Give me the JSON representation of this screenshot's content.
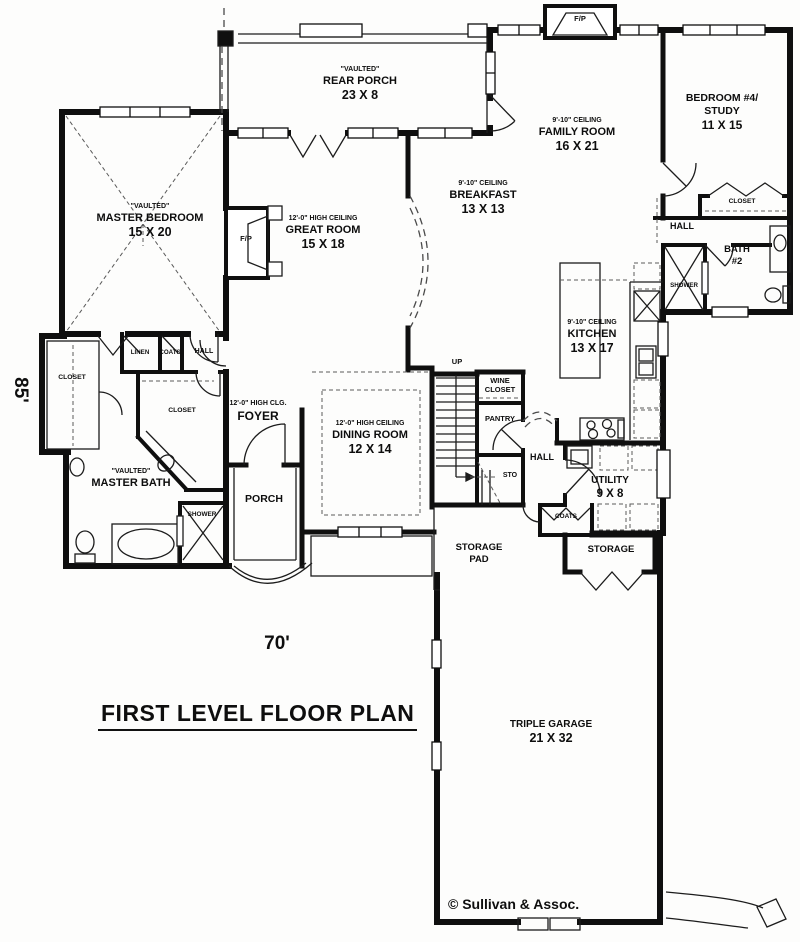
{
  "plan": {
    "title": "FIRST LEVEL FLOOR PLAN",
    "width_dim": "70'",
    "height_dim": "85'",
    "copyright": "© Sullivan & Assoc."
  },
  "rooms": {
    "master_bedroom": {
      "note": "\"VAULTED\"",
      "name": "MASTER BEDROOM",
      "dims": "15 X 20"
    },
    "rear_porch": {
      "note": "\"VAULTED\"",
      "name": "REAR PORCH",
      "dims": "23 X 8"
    },
    "great_room": {
      "note": "12'-0\" HIGH CEILING",
      "name": "GREAT ROOM",
      "dims": "15 X 18"
    },
    "family_room": {
      "note": "9'-10\" CEILING",
      "name": "FAMILY ROOM",
      "dims": "16 X 21"
    },
    "breakfast": {
      "note": "9'-10\" CEILING",
      "name": "BREAKFAST",
      "dims": "13 X 13"
    },
    "bedroom_4": {
      "name_line1": "BEDROOM #4/",
      "name_line2": "STUDY",
      "dims": "11 X 15"
    },
    "kitchen": {
      "note": "9'-10\" CEILING",
      "name": "KITCHEN",
      "dims": "13 X 17"
    },
    "dining_room": {
      "note": "12'-0\" HIGH CEILING",
      "name": "DINING ROOM",
      "dims": "12 X 14"
    },
    "foyer": {
      "note": "12'-0\" HIGH CLG.",
      "name": "FOYER"
    },
    "master_bath": {
      "note": "\"VAULTED\"",
      "name": "MASTER BATH"
    },
    "utility": {
      "name": "UTILITY",
      "dims": "9 X 8"
    },
    "triple_garage": {
      "name": "TRIPLE GARAGE",
      "dims": "21 X 32"
    },
    "front_porch": {
      "name": "PORCH"
    },
    "storage_pad": {
      "line1": "STORAGE",
      "line2": "PAD"
    },
    "storage": {
      "name": "STORAGE"
    },
    "wine_closet": {
      "line1": "WINE",
      "line2": "CLOSET"
    },
    "pantry": {
      "name": "PANTRY"
    },
    "bath_2": {
      "line1": "BATH",
      "line2": "#2"
    }
  },
  "small_labels": {
    "hall_left": "HALL",
    "hall_center": "HALL",
    "hall_right": "HALL",
    "closet_left": "CLOSET",
    "closet_master": "CLOSET",
    "closet_bedroom4": "CLOSET",
    "linen": "LINEN",
    "coats_upper": "COATS",
    "coats_lower": "COATS",
    "shower_master": "SHOWER",
    "shower_bath2": "SHOWER",
    "fireplace_great": "F/P",
    "fireplace_family": "F/P",
    "stairs_up": "UP",
    "stairs_storage": "STO"
  }
}
